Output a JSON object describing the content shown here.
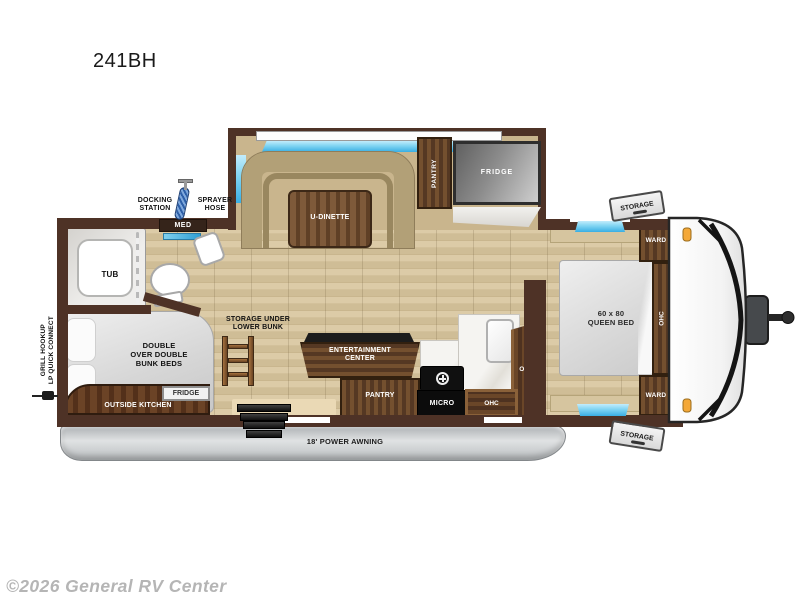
{
  "title": "241BH",
  "watermark": "©2026 General RV Center",
  "colors": {
    "wall_brown": "#4e3226",
    "cabinet_wood": "#6a4628",
    "floor_tan": "#d3c19b",
    "slide_floor": "#c9b58d",
    "window_blue": "#7fd4f2",
    "awning_gray": "#c9ccce",
    "marker_light_orange": "#f4a838",
    "appliance_black": "#101010"
  },
  "labels": {
    "docking_station": "DOCKING\nSTATION",
    "sprayer_hose": "SPRAYER\nHOSE",
    "med": "MED",
    "tub": "TUB",
    "u_dinette": "U-DINETTE",
    "pantry_slide": "PANTRY",
    "fridge_slide": "FRIDGE",
    "storage_front_top": "STORAGE",
    "ward_top": "WARD",
    "ohc_bedroom": "OHC",
    "queen_bed": "60 x 80\nQUEEN BED",
    "ward_bottom": "WARD",
    "storage_front_bottom": "STORAGE",
    "bunk_beds": "DOUBLE\nOVER DOUBLE\nBUNK BEDS",
    "storage_under_bunk": "STORAGE UNDER\nLOWER BUNK",
    "outside_kitchen": "OUTSIDE KITCHEN",
    "outside_fridge": "FRIDGE",
    "entertainment_center": "ENTERTAINMENT\nCENTER",
    "pantry_kitchen": "PANTRY",
    "micro": "MICRO",
    "ohc_kitchen_upper": "OHC",
    "ohc_kitchen_lower": "OHC",
    "awning": "18' POWER AWNING",
    "grill_hookup": "GRILL HOOKUP\nLP QUICK CONNECT"
  }
}
